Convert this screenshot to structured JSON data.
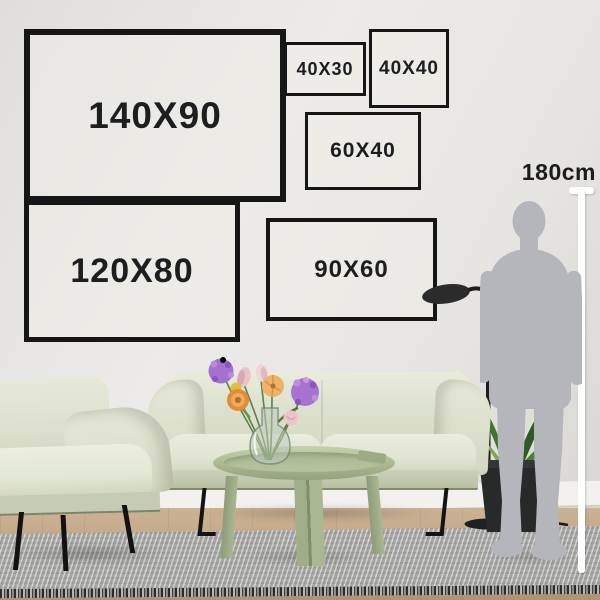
{
  "frames": [
    {
      "label": "140X90"
    },
    {
      "label": "40X30"
    },
    {
      "label": "40X40"
    },
    {
      "label": "60X40"
    },
    {
      "label": "120X80"
    },
    {
      "label": "90X60"
    }
  ],
  "measure": {
    "label": "180cm"
  },
  "icons": {
    "person": "person-silhouette",
    "lamp": "floor-lamp",
    "plant": "potted-plant",
    "sofa": "sofa",
    "armchair": "armchair",
    "table": "coffee-table",
    "vase": "flower-vase",
    "rug": "rug"
  },
  "colors": {
    "frame_border": "#161616",
    "label_text": "#1d1e1f",
    "measure_line": "#ffffff",
    "sofa": "#dde1cf",
    "table": "#a9b792",
    "rug": "#b6b6b4",
    "floor": "#c1a584",
    "person": "#b4b6bb",
    "lamp": "#2b2b2b",
    "leaf_green": "#4c8038",
    "flower_purple": "#a873cf",
    "flower_orange": "#df8c3c",
    "flower_peach": "#f0b169",
    "flower_pink": "#e9c3ca",
    "flower_yellow": "#dfc13a"
  }
}
